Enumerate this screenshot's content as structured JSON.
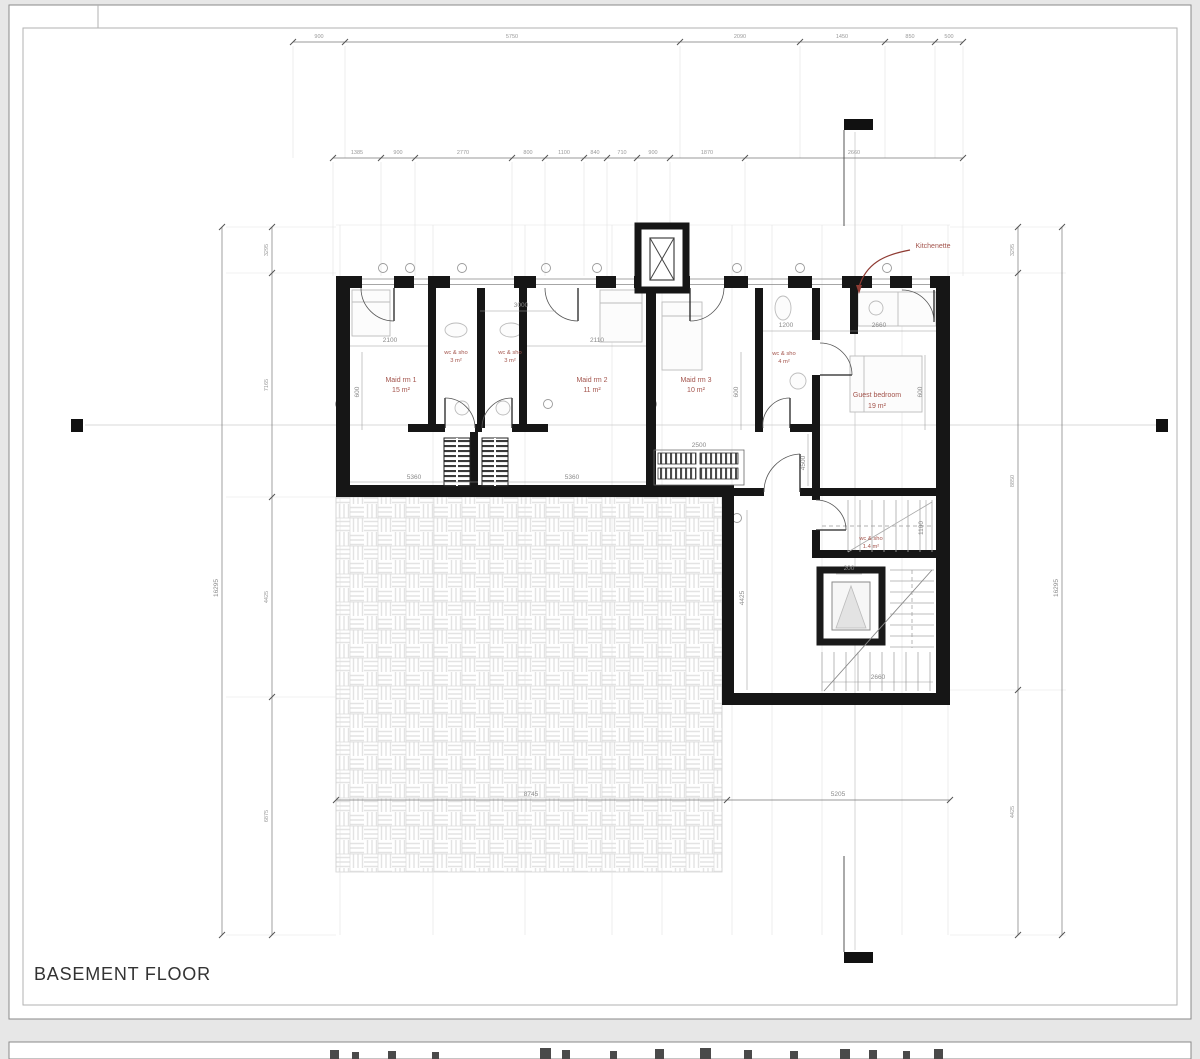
{
  "page": {
    "title": "BASEMENT FLOOR"
  },
  "annotations": {
    "kitchenette": "Kitchenette"
  },
  "rooms": {
    "maid1": {
      "name": "Maid rm 1",
      "area": "15 m²"
    },
    "wc1": {
      "name": "wc & sho",
      "area": "3 m²"
    },
    "wc2": {
      "name": "wc & sho",
      "area": "3 m²"
    },
    "maid2": {
      "name": "Maid rm 2",
      "area": "11 m²"
    },
    "maid3": {
      "name": "Maid rm 3",
      "area": "10 m²"
    },
    "wc3": {
      "name": "wc & sho",
      "area": "4 m²"
    },
    "guest": {
      "name": "Guest bedroom",
      "area": "19 m²"
    },
    "wc4": {
      "name": "wc & sho",
      "area": "1.4 m²"
    }
  },
  "dims": {
    "top_row": [
      "900",
      "5750",
      "2090",
      "1450",
      "850",
      "500"
    ],
    "second_row": [
      "1385",
      "900",
      "2770",
      "800",
      "1100",
      "840",
      "710",
      "900",
      "1870",
      "2660"
    ],
    "bottom_row": [
      "8745",
      "5205"
    ],
    "left_outer": "16295",
    "left_inner": [
      "3295",
      "7165",
      "4425",
      "6875"
    ],
    "right_inner": [
      "3295",
      "8850",
      "4425"
    ],
    "right_outer": "16295",
    "interior": {
      "maid1_w": "2100",
      "wc_w": "3000",
      "maid2_w": "2110",
      "wc3_w": "1200",
      "kitch_w": "2660",
      "closet_w": "2500",
      "floor1": "5360",
      "floor2": "5360",
      "maid1_h": "600",
      "maid3_h": "600",
      "guest_h": "600",
      "hall_h": "4500",
      "wc4_h": "1100",
      "duct": "200",
      "stair_w": "2660",
      "court_h": "4425"
    }
  }
}
